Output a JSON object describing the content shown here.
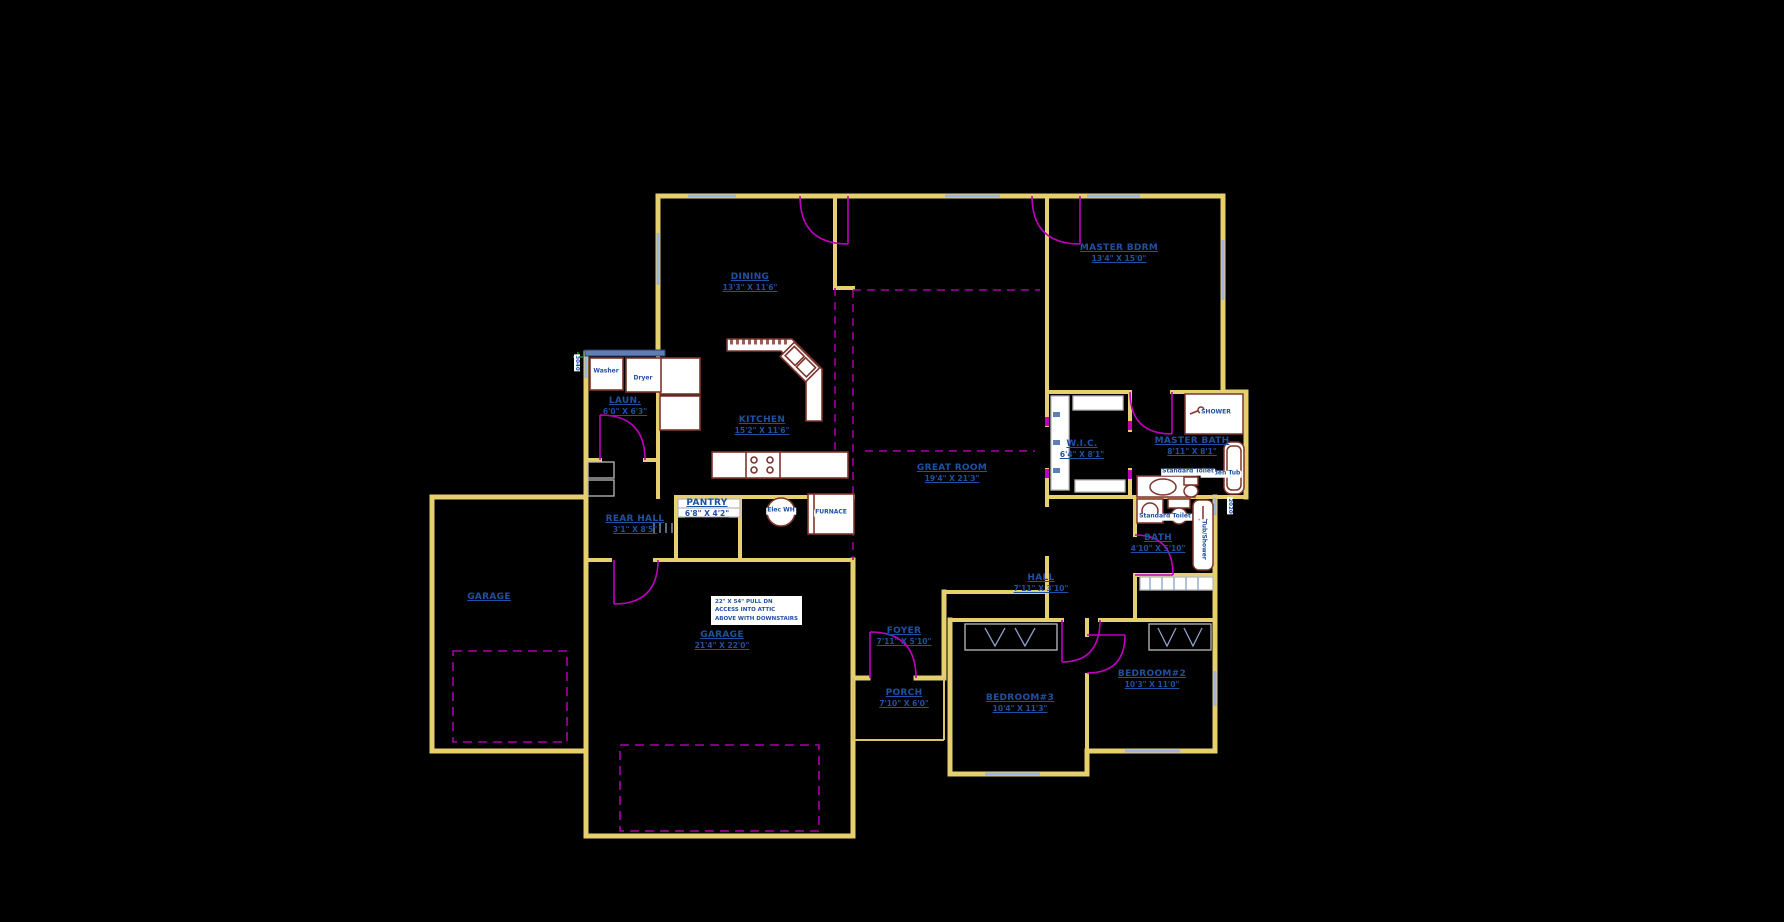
{
  "canvas": {
    "background": "#000000",
    "width": 1784,
    "height": 922
  },
  "colors": {
    "wall": "#E6CF6E",
    "door_magenta": "#BE00BE",
    "ceiling_dashed": "#A800A8",
    "label_blue": "#2050A0",
    "cabinet_maroon": "#7E352D",
    "counter_blue": "#5F7FB2",
    "window_blue": "#9FB6DC",
    "shelf_steel": "#8CA0C8",
    "marker_green": "#00A000"
  },
  "rooms": {
    "dining": {
      "name": "DINING",
      "dims": "13'3\" X 11'6\""
    },
    "master_bdrm": {
      "name": "MASTER BDRM",
      "dims": "13'4\" X 15'0\""
    },
    "laundry": {
      "name": "LAUN.",
      "dims": "6'0\" X 6'3\""
    },
    "kitchen": {
      "name": "KITCHEN",
      "dims": "15'2\" X 11'6\""
    },
    "great_room": {
      "name": "GREAT ROOM",
      "dims": "19'4\" X 21'3\""
    },
    "wic": {
      "name": "W.I.C.",
      "dims": "6'4\" X 8'1\""
    },
    "master_bath": {
      "name": "MASTER BATH",
      "dims": "8'11\" X 8'1\""
    },
    "pantry": {
      "name": "PANTRY",
      "dims": "6'8\" X 4'2\""
    },
    "rear_hall": {
      "name": "REAR HALL",
      "dims": "3'1\" X 8'5\""
    },
    "garage_single": {
      "name": "GARAGE",
      "dims": ""
    },
    "garage_main": {
      "name": "GARAGE",
      "dims": "21'4\" X 22'0\""
    },
    "foyer": {
      "name": "FOYER",
      "dims": "7'11\" X 5'10\""
    },
    "porch": {
      "name": "PORCH",
      "dims": "7'10\" X 6'0\""
    },
    "hall": {
      "name": "HALL",
      "dims": "7'11\" X 3'10\""
    },
    "bath": {
      "name": "BATH",
      "dims": "4'10\" X 5'10\""
    },
    "bedroom3": {
      "name": "BEDROOM#3",
      "dims": "10'4\" X 11'3\""
    },
    "bedroom2": {
      "name": "BEDROOM#2",
      "dims": "10'3\" X 11'0\""
    }
  },
  "fixtures": {
    "washer": "Washer",
    "dryer": "Dryer",
    "elec_wh": "Elec WH",
    "furnace": "FURNACE",
    "shower": "SHOWER",
    "garden_tub": "Garden Tub",
    "toilet_master": "Standard Toilet",
    "toilet_bath": "Standard Toilet",
    "tub_shower": "Tub/Shower"
  },
  "window_tags": {
    "laundry_wall": "3040",
    "bath_wall": "2020"
  },
  "attic_note": {
    "line1": "22\" X 54\" PULL DN",
    "line2": "ACCESS INTO ATTIC",
    "line3": "ABOVE WITH DOWNSTAIRS"
  }
}
